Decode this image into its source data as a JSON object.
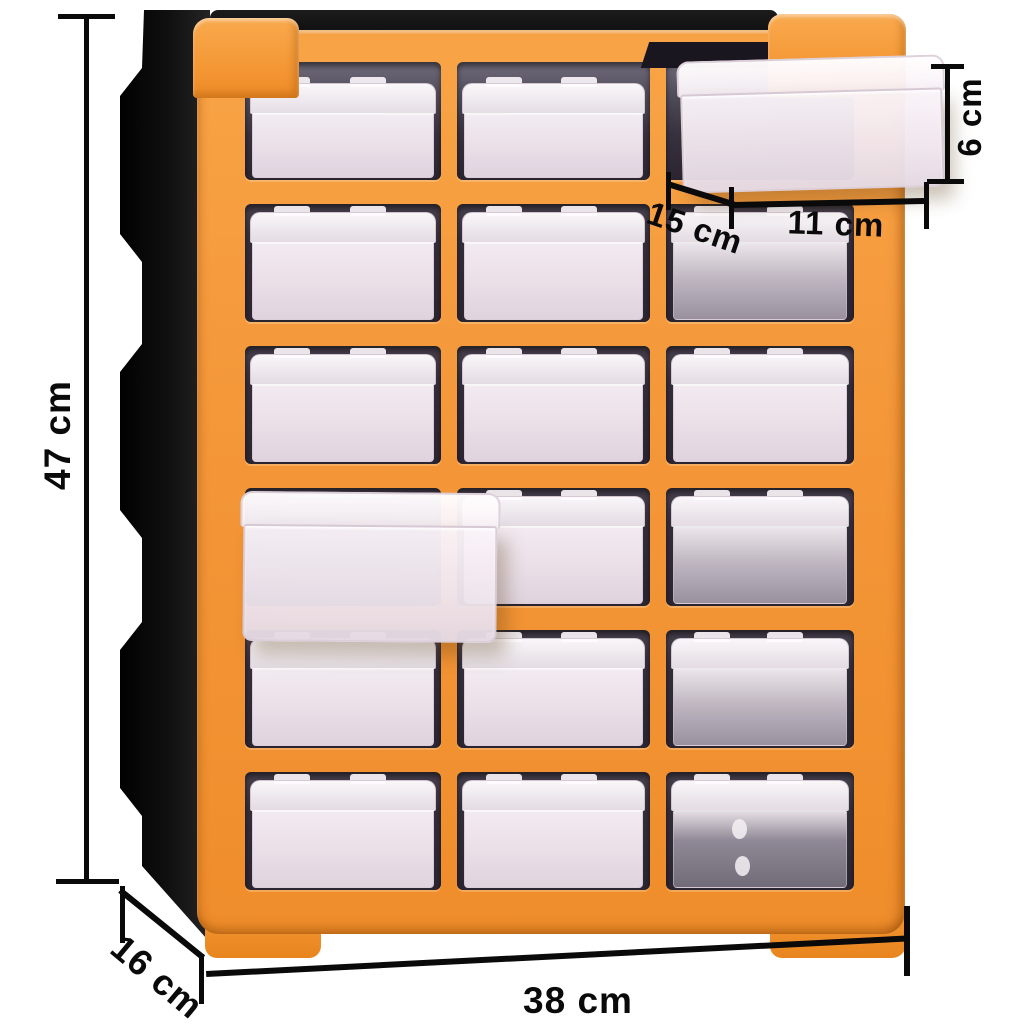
{
  "scene": {
    "background_color": "#ffffff",
    "description": "Product dimension diagram of a multi-drawer organiser cabinet with transparent drawers"
  },
  "product": {
    "name": "multi-drawer-organiser",
    "colors": {
      "frame_orange": "#f49739",
      "frame_shade": "#e8851e",
      "body_black": "#101010",
      "drawer_tint_light": "#f2e7ef",
      "drawer_tint_gray": "#9d95a2",
      "opening_dark": "#2c2532"
    },
    "grid": {
      "rows": 6,
      "columns": 3,
      "total_drawers": 18
    },
    "drawer_tones": [
      [
        "light",
        "light",
        "open"
      ],
      [
        "light",
        "light",
        "gray"
      ],
      [
        "light",
        "light",
        "light"
      ],
      [
        "open",
        "light",
        "gray"
      ],
      [
        "light",
        "light",
        "gray"
      ],
      [
        "light",
        "light",
        "dark"
      ]
    ],
    "pulled_drawers": [
      {
        "position": "row 1, column 3",
        "state": "pulled out to the right"
      },
      {
        "position": "row 4, column 1",
        "state": "pulled out to the front"
      }
    ]
  },
  "annotation_style": {
    "line_color": "#0a0a0a",
    "text_color": "#0a0a0a"
  },
  "dims": [
    {
      "id": "height",
      "label": "47 cm",
      "orientation": "vertical",
      "location": "left edge"
    },
    {
      "id": "depth",
      "label": "16 cm",
      "orientation": "diagonal",
      "location": "bottom left"
    },
    {
      "id": "width",
      "label": "38 cm",
      "orientation": "horizontal",
      "location": "bottom"
    },
    {
      "id": "drawer_depth",
      "label": "15 cm",
      "orientation": "diagonal",
      "location": "beside pulled-out top drawer"
    },
    {
      "id": "drawer_width",
      "label": "11 cm",
      "orientation": "horizontal",
      "location": "under pulled-out top drawer"
    },
    {
      "id": "drawer_height",
      "label": "6 cm",
      "orientation": "vertical",
      "location": "right of pulled-out top drawer"
    }
  ]
}
